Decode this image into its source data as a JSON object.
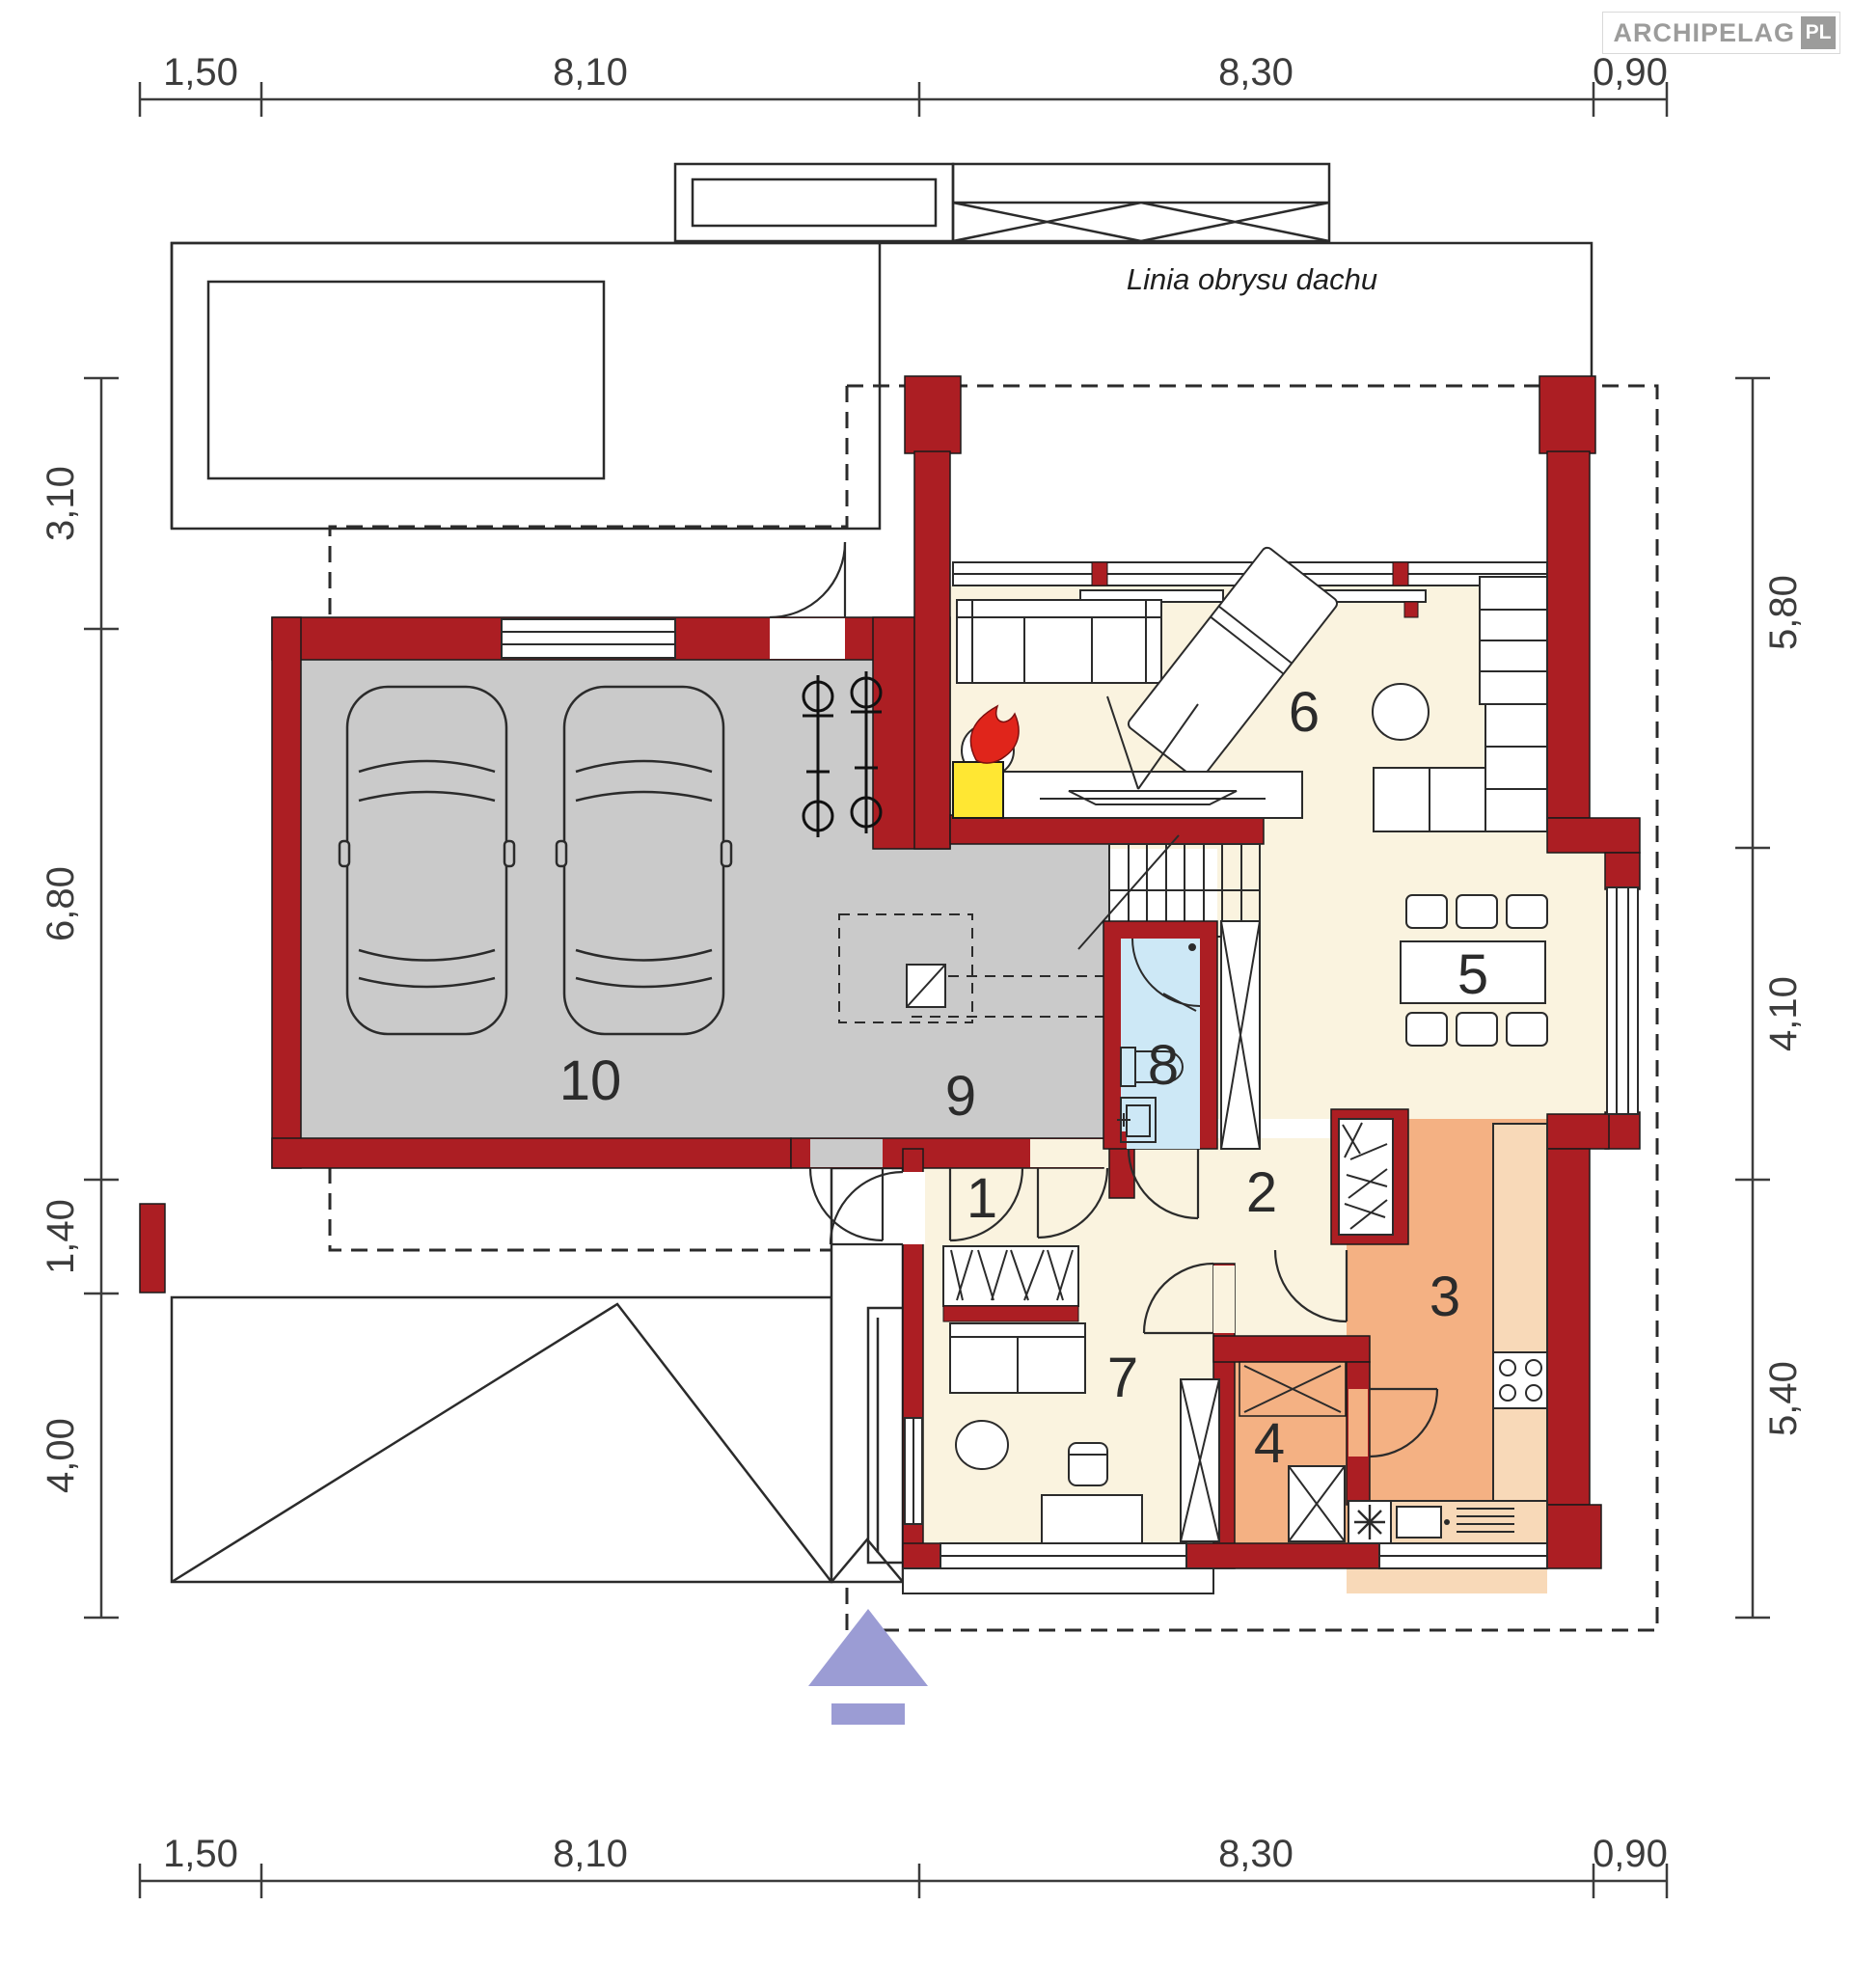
{
  "logo": {
    "brand": "ARCHIPELAG",
    "country": "PL"
  },
  "labels": {
    "roof_outline": "Linia obrysu dachu"
  },
  "dimensions": {
    "top": [
      "1,50",
      "8,10",
      "8,30",
      "0,90"
    ],
    "bottom": [
      "1,50",
      "8,10",
      "8,30",
      "0,90"
    ],
    "left": [
      "3,10",
      "6,80",
      "1,40",
      "4,00"
    ],
    "right": [
      "5,80",
      "4,10",
      "5,40"
    ]
  },
  "rooms": [
    {
      "number": "1"
    },
    {
      "number": "2"
    },
    {
      "number": "3"
    },
    {
      "number": "4"
    },
    {
      "number": "5"
    },
    {
      "number": "6"
    },
    {
      "number": "7"
    },
    {
      "number": "8"
    },
    {
      "number": "9"
    },
    {
      "number": "10"
    }
  ],
  "colors": {
    "wall": "#AC1E23",
    "garage_floor": "#CACACA",
    "living_floor": "#FAF3DF",
    "kitchen_floor": "#F4B183",
    "counter": "#F8D9B8",
    "bathroom_floor": "#CDE8F6",
    "fireplace_yellow": "#FFE733",
    "flame_red": "#E0251B",
    "entrance_arrow": "#9B9CD4",
    "logo_gray": "#9C9C9B"
  }
}
